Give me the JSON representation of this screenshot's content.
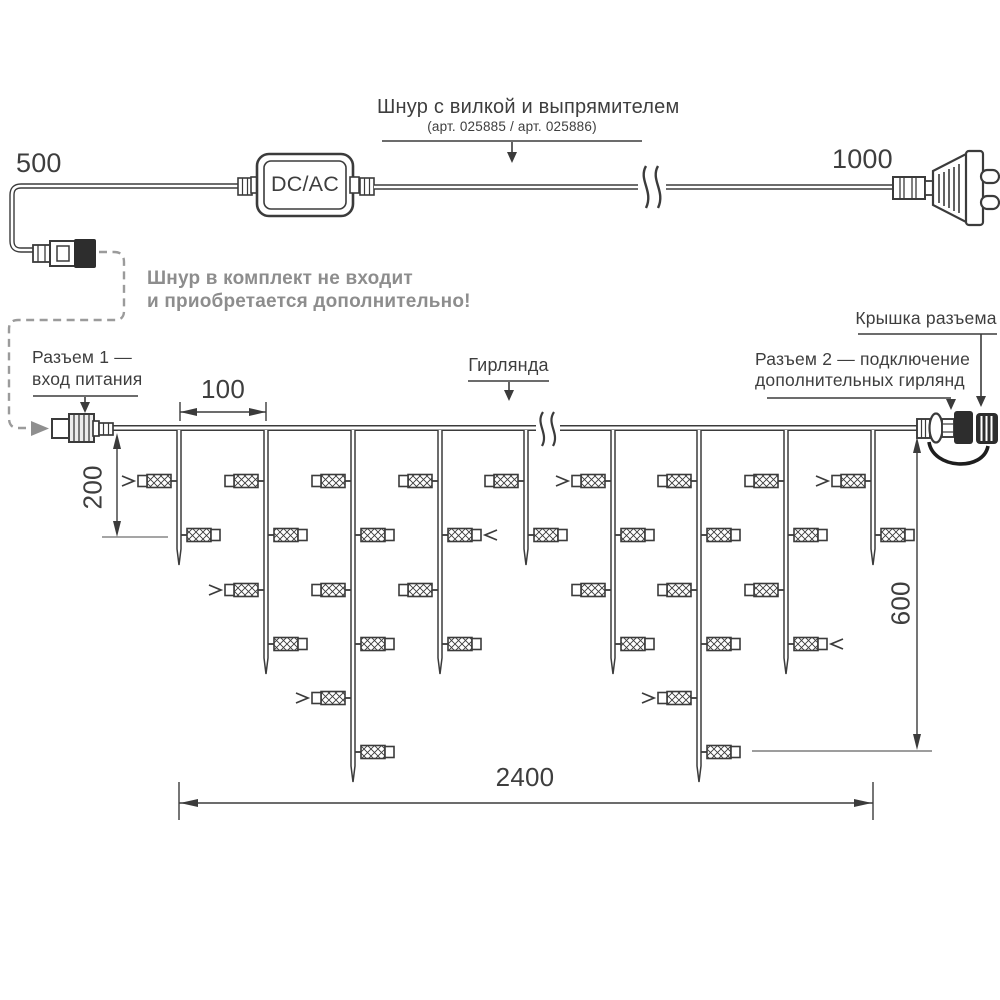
{
  "labels": {
    "cord_title": "Шнур с вилкой и выпрямителем",
    "cord_subtitle": "(арт. 025885 / арт. 025886)",
    "note_line1": "Шнур в комплект не входит",
    "note_line2": "и приобретается дополнительно!",
    "connector1_line1": "Разъем 1 —",
    "connector1_line2": "вход питания",
    "garland_label": "Гирлянда",
    "connector2_line1": "Разъем 2 — подключение",
    "connector2_line2": "дополнительных гирлянд",
    "cap_label": "Крышка разъема",
    "dcac": "DC/AC"
  },
  "dimensions": {
    "cord_left_mm": "500",
    "cord_right_mm": "1000",
    "drop_spacing_mm": "100",
    "first_light_mm": "200",
    "drop_max_mm": "600",
    "garland_length_mm": "2400"
  },
  "colors": {
    "line": "#3b3b3b",
    "gray": "#8f8f8f",
    "black_part": "#2d2d2d"
  },
  "garland": {
    "wire_y": 428,
    "wire_x1": 113,
    "wire_x2": 918,
    "row_ys": [
      481,
      535,
      590,
      644,
      698,
      752
    ],
    "drops": [
      {
        "x": 179,
        "lights": 2
      },
      {
        "x": 266,
        "lights": 4
      },
      {
        "x": 353,
        "lights": 6
      },
      {
        "x": 440,
        "lights": 4
      },
      {
        "x": 526,
        "lights": 2
      },
      {
        "x": 613,
        "lights": 4
      },
      {
        "x": 699,
        "lights": 6
      },
      {
        "x": 786,
        "lights": 4
      },
      {
        "x": 873,
        "lights": 2
      }
    ],
    "flash_arrows": [
      {
        "drop": 0,
        "row": 0
      },
      {
        "drop": 1,
        "row": 2
      },
      {
        "drop": 2,
        "row": 4
      },
      {
        "drop": 3,
        "row": 1
      },
      {
        "drop": 5,
        "row": 0
      },
      {
        "drop": 6,
        "row": 4
      },
      {
        "drop": 7,
        "row": 3
      },
      {
        "drop": 8,
        "row": 0
      }
    ]
  }
}
